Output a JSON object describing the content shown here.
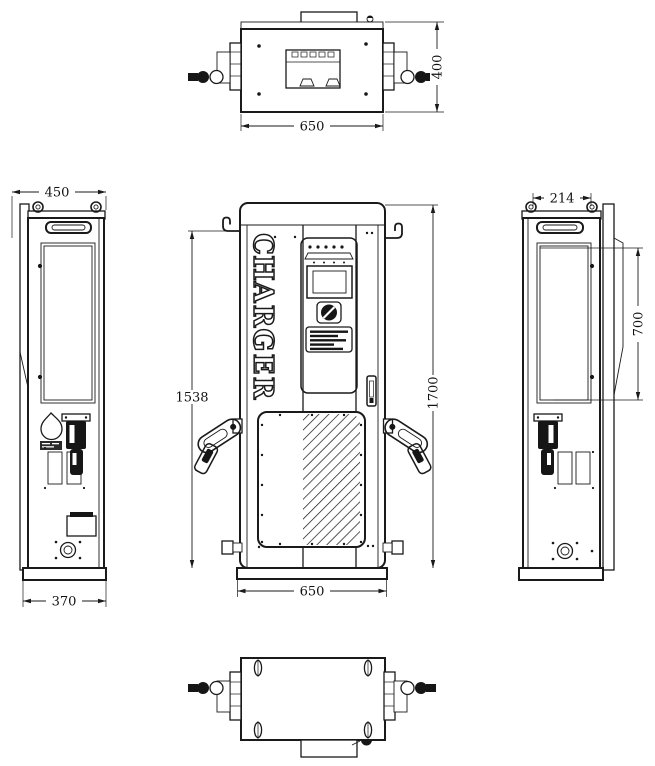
{
  "drawing": {
    "title": "charger-cabinet-technical-drawing",
    "product_label": "CHARGER",
    "charger_letters": [
      "C",
      "H",
      "A",
      "R",
      "G",
      "E",
      "R"
    ],
    "dimensions": {
      "top_width": "650",
      "top_depth": "400",
      "front_height_frame": "1538",
      "front_height_overall": "1700",
      "front_width": "650",
      "left_depth": "450",
      "left_base_depth": "370",
      "right_eye_spacing": "214",
      "right_louver_height": "700"
    },
    "colors": {
      "line": "#1a1a1a",
      "background": "#ffffff"
    }
  }
}
